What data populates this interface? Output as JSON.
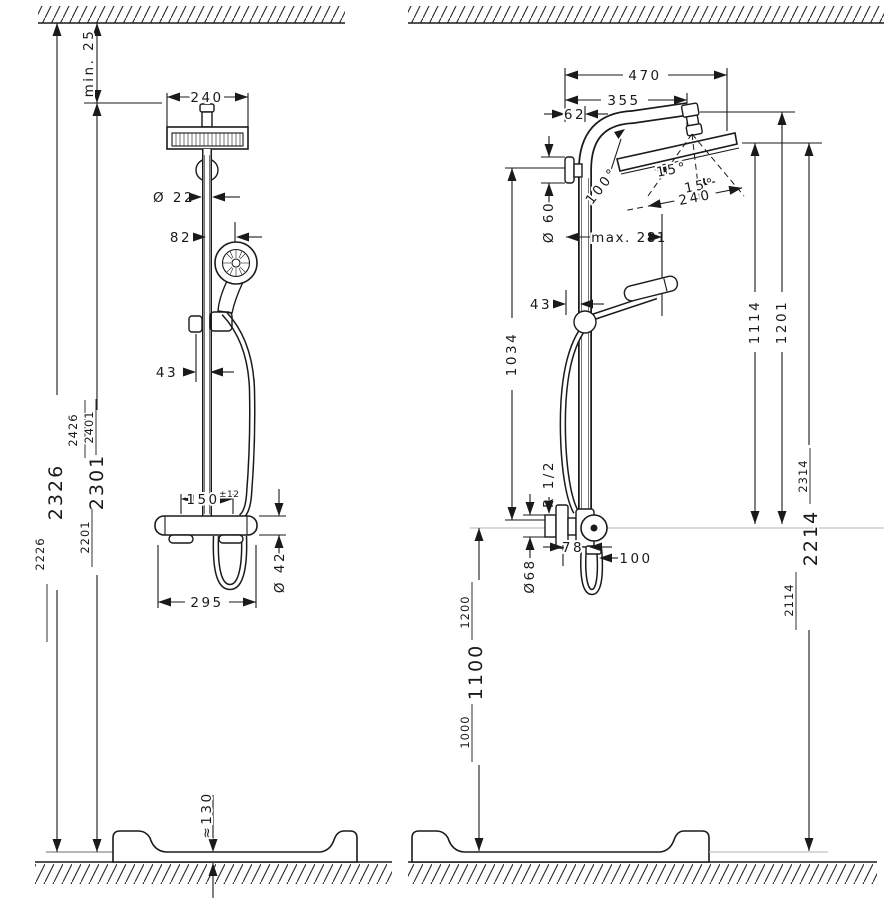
{
  "figure_left": {
    "view": "front-view",
    "heights_outer": {
      "low": "2226",
      "mid": "2326",
      "high": "2426"
    },
    "heights_inner": {
      "low": "2201",
      "mid": "2301",
      "high": "2401"
    },
    "dims": {
      "ceiling_gap": "min. 25",
      "head_width": "240",
      "pipe_diameter": "Ø 22",
      "handshower_offset": "82",
      "slider_offset": "43",
      "valve_centers": "150",
      "valve_centers_tolerance": "±12",
      "valve_diameter": "Ø 42",
      "valve_width": "295",
      "tray_height": "≈130"
    }
  },
  "figure_right": {
    "view": "side-view",
    "heights_valve": {
      "low": "1000",
      "mid": "1100",
      "high": "1200"
    },
    "heights_head": {
      "low": "2114",
      "mid": "2214",
      "high": "2314"
    },
    "dims": {
      "arm_reach_overall": "470",
      "arm_reach": "355",
      "wall_to_pipe": "62",
      "arm_angle": "100°",
      "escutcheon_diameter": "Ø 60",
      "swivel_left": "15°",
      "swivel_right": "15°",
      "head_size": "240",
      "holder_reach": "max. 281",
      "holder_offset": "43",
      "bracket_to_valve": "1034",
      "head_to_valve": "1114",
      "arm_to_valve": "1201",
      "thread": "R 1/2",
      "union_diameter": "Ø68",
      "union_offset": "78",
      "hose_clearance": "100"
    }
  }
}
